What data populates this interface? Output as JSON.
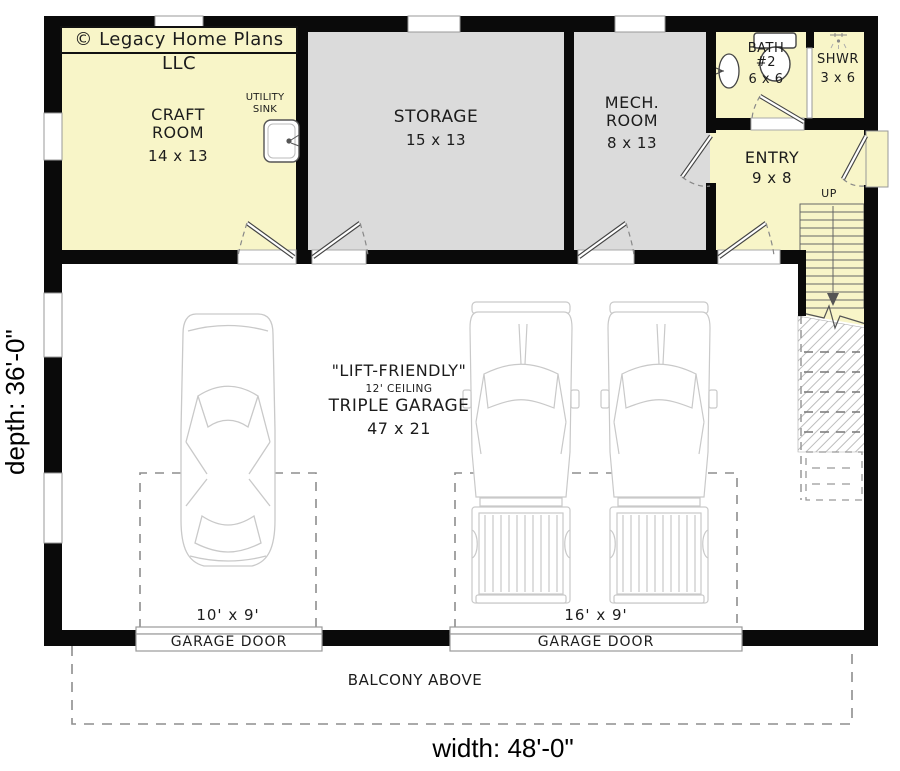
{
  "title_block": {
    "copyright": "© Legacy Home Plans LLC"
  },
  "dimensions": {
    "depth": "depth: 36'-0\"",
    "width": "width: 48'-0\""
  },
  "rooms": {
    "craft_room": {
      "name_line1": "CRAFT",
      "name_line2": "ROOM",
      "size": "14 x 13"
    },
    "storage": {
      "name": "STORAGE",
      "size": "15 x 13"
    },
    "mech_room": {
      "name_line1": "MECH.",
      "name_line2": "ROOM",
      "size": "8 x 13"
    },
    "bath_2": {
      "name_line1": "BATH",
      "name_line2": "#2",
      "size": "6 x 6"
    },
    "shower": {
      "name": "SHWR",
      "size": "3 x 6"
    },
    "entry": {
      "name": "ENTRY",
      "size": "9 x 8"
    },
    "garage": {
      "tagline": "\"LIFT-FRIENDLY\"",
      "ceiling": "12' CEILING",
      "name": "TRIPLE GARAGE",
      "size": "47 x 21"
    }
  },
  "fixtures": {
    "utility_sink_line1": "UTILITY",
    "utility_sink_line2": "SINK"
  },
  "stairs": {
    "direction_label": "UP"
  },
  "garage_doors": {
    "left": {
      "size": "10' x 9'",
      "label": "GARAGE DOOR"
    },
    "right": {
      "size": "16' x 9'",
      "label": "GARAGE DOOR"
    }
  },
  "balcony": {
    "label": "BALCONY ABOVE"
  },
  "colors": {
    "room_yellow": "#f8f5c8",
    "room_gray": "#dbdbdb",
    "wall": "#0a0a0a",
    "vehicle_outline": "#c9c9c9",
    "dashed_gray": "#8e8e8e"
  }
}
